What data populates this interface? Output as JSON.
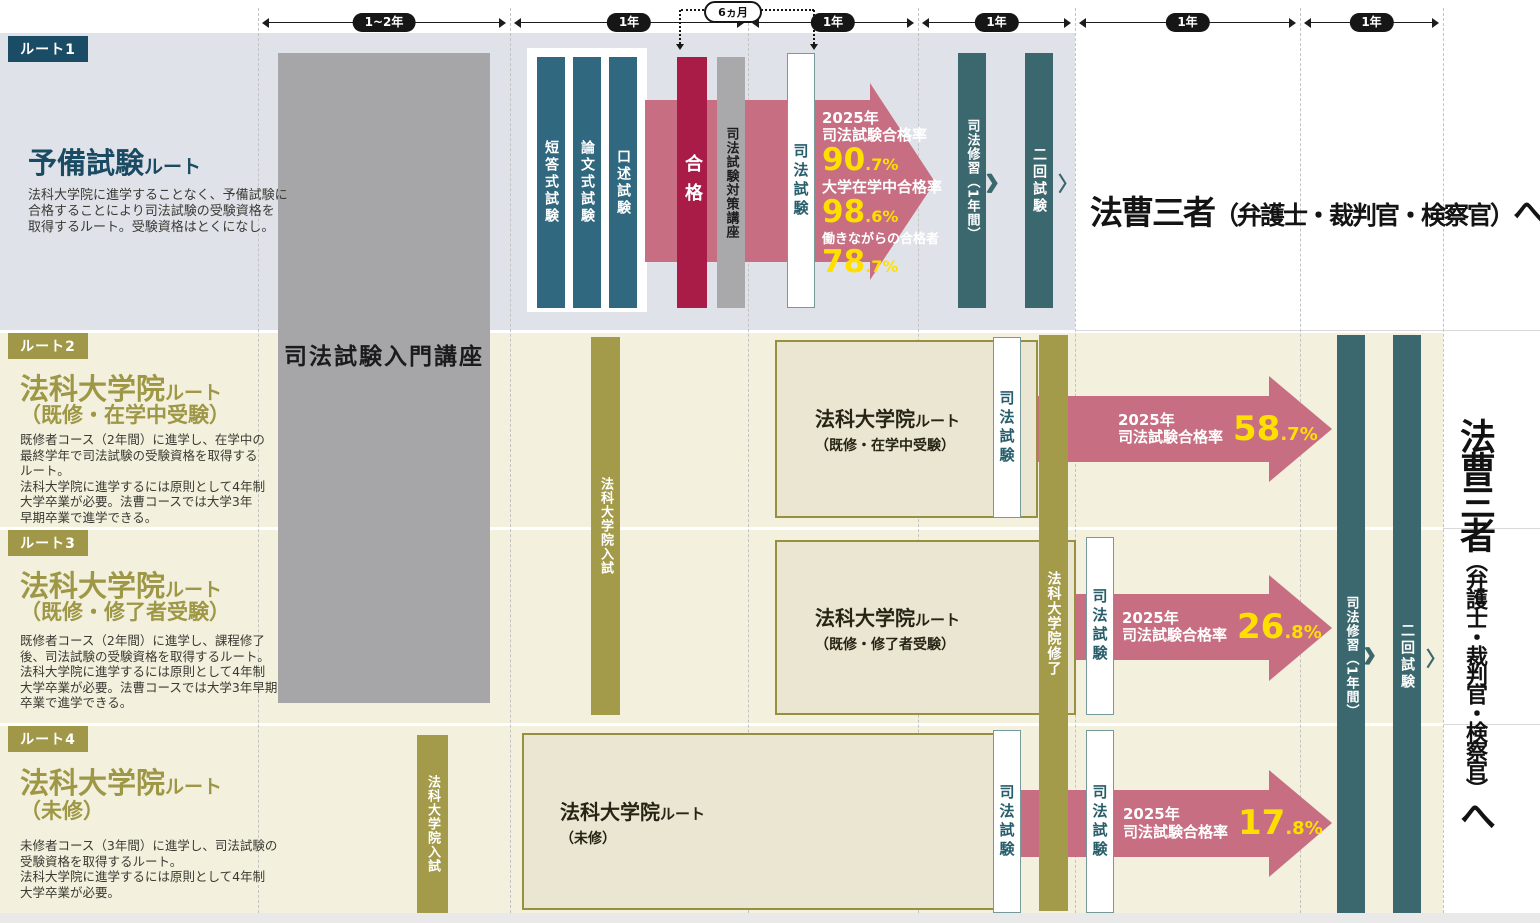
{
  "colors": {
    "navy": "#1b4c66",
    "olive": "#a09848",
    "blue_bar": "#30687f",
    "crimson": "#a81c47",
    "pink_arrow": "#c76e82",
    "yellow": "#ffdf00",
    "teal_bar": "#3a686e",
    "gray_box": "#a6a6a9",
    "route1_bg": "#dfe3e9",
    "cream_bg": "#f3f0dd",
    "box_fill": "#eae6d1"
  },
  "timeline": {
    "segments": [
      {
        "label": "1~2年"
      },
      {
        "label": "1年"
      },
      {
        "label": "1年"
      },
      {
        "label": "1年"
      },
      {
        "label": "1年"
      },
      {
        "label": "1年"
      }
    ],
    "callout": "6ヵ月"
  },
  "bars": {
    "intro_course": "司法試験入門講座",
    "exam_steps": [
      "短答式試験",
      "論文式試験",
      "口述試験"
    ],
    "pass": "合格",
    "prep_course": "司法試験対策講座",
    "bar_exam": "司法試験",
    "training": "司法修習（1年間）",
    "second_exam": "二回試験",
    "ls_entrance": "法科大学院入試",
    "ls_completion": "法科大学院修了"
  },
  "goal": {
    "main": "法曹三者",
    "paren": "（弁護士・裁判官・検察官）",
    "to": "へ"
  },
  "glyphs": {
    "chevrons": "〉〉〉〉",
    "chevron": "〉"
  },
  "routes": {
    "r1": {
      "tab": "ルート1",
      "title_main": "予備試験",
      "title_sub": "ルート",
      "desc": "法科大学院に進学することなく、予備試験に\n合格することにより司法試験の受験資格を\n取得するルート。受験資格はとくになし。",
      "stats": [
        {
          "heading": "2025年\n司法試験合格率",
          "big": "90",
          "frac": ".7%"
        },
        {
          "heading": "大学在学中合格率",
          "big": "98",
          "frac": ".6%"
        },
        {
          "heading": "働きながらの合格者",
          "big": "78",
          "frac": ".7%"
        }
      ]
    },
    "r2": {
      "tab": "ルート2",
      "title_main": "法科大学院",
      "title_sub": "ルート",
      "title_paren": "（既修・在学中受験）",
      "desc": "既修者コース（2年間）に進学し、在学中の\n最終学年で司法試験の受験資格を取得する\nルート。\n法科大学院に進学するには原則として4年制\n大学卒業が必要。法曹コースでは大学3年\n早期卒業で進学できる。",
      "box_main": "法科大学院",
      "box_sub": "ルート",
      "box_paren": "（既修・在学中受験）",
      "arrow": {
        "heading": "2025年\n司法試験合格率",
        "big": "58",
        "frac": ".7%"
      }
    },
    "r3": {
      "tab": "ルート3",
      "title_main": "法科大学院",
      "title_sub": "ルート",
      "title_paren": "（既修・修了者受験）",
      "desc": "既修者コース（2年間）に進学し、課程修了\n後、司法試験の受験資格を取得するルート。\n法科大学院に進学するには原則として4年制\n大学卒業が必要。法曹コースでは大学3年早期\n卒業で進学できる。",
      "box_main": "法科大学院",
      "box_sub": "ルート",
      "box_paren": "（既修・修了者受験）",
      "arrow": {
        "heading": "2025年\n司法試験合格率",
        "big": "26",
        "frac": ".8%"
      }
    },
    "r4": {
      "tab": "ルート4",
      "title_main": "法科大学院",
      "title_sub": "ルート",
      "title_paren": "（未修）",
      "desc": "未修者コース（3年間）に進学し、司法試験の\n受験資格を取得するルート。\n法科大学院に進学するには原則として4年制\n大学卒業が必要。",
      "box_main": "法科大学院",
      "box_sub": "ルート",
      "box_paren": "（未修）",
      "arrow": {
        "heading": "2025年\n司法試験合格率",
        "big": "17",
        "frac": ".8%"
      }
    }
  }
}
